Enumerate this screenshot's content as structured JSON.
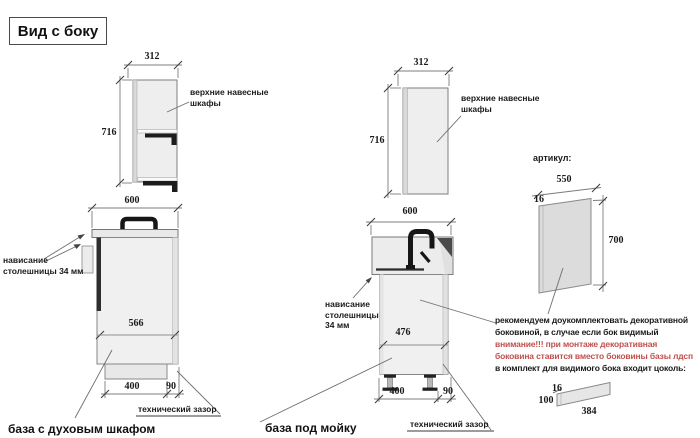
{
  "title": "Вид с боку",
  "colors": {
    "warning_red": "#c0504d",
    "cabinet_fill": "#ededed"
  },
  "left_section": {
    "upper_cabinet": {
      "width_dim": "312",
      "height_dim": "716",
      "label_line1": "верхние навесные",
      "label_line2": "шкафы"
    },
    "base_cabinet": {
      "width_dim": "600",
      "inner_dim": "566",
      "plinth_dim": "400",
      "gap_dim": "90",
      "overhang_line1": "нависание",
      "overhang_line2": "столешницы 34 мм",
      "gap_label": "технический зазор",
      "caption": "база с духовым шкафом"
    }
  },
  "middle_section": {
    "upper_cabinet": {
      "width_dim": "312",
      "height_dim": "716",
      "label_line1": "верхние навесные",
      "label_line2": "шкафы"
    },
    "base_cabinet": {
      "width_dim": "600",
      "inner_dim": "476",
      "plinth_dim": "400",
      "gap_dim": "90",
      "overhang_line1": "нависание",
      "overhang_line2": "столешницы",
      "overhang_line3": "34 мм",
      "gap_label": "технический зазор",
      "caption": "база под мойку"
    }
  },
  "right_section": {
    "heading": "артикул:",
    "side_panel": {
      "width_dim": "550",
      "thickness_dim": "16",
      "height_dim": "700"
    },
    "note_lines": [
      {
        "text": "рекомендуем доукомплектовать декоративной",
        "color": "black"
      },
      {
        "text": "боковиной, в случае если бок видимый",
        "color": "black"
      },
      {
        "text": "внимание!!! при монтаже декоративная",
        "color": "red"
      },
      {
        "text": "боковина ставится вместо боковины базы лдсп",
        "color": "red"
      },
      {
        "text": "в комплект для видимого бока входит цоколь:",
        "color": "black"
      }
    ],
    "plinth": {
      "thickness_dim": "16",
      "height_dim": "100",
      "length_dim": "384"
    }
  }
}
